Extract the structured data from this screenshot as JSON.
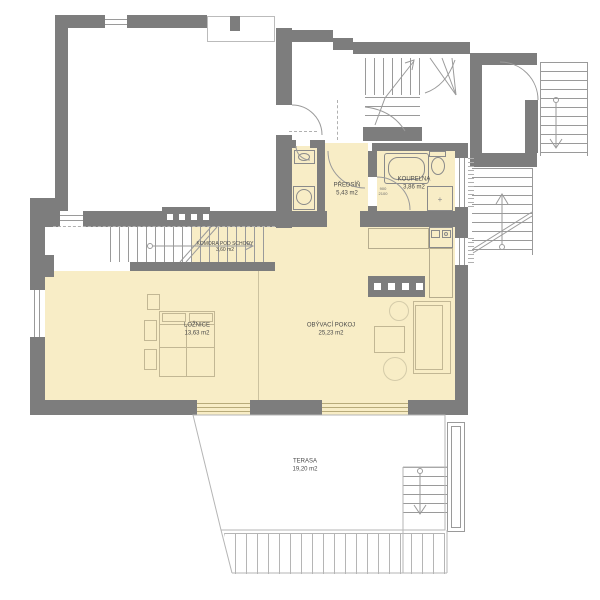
{
  "colors": {
    "wall": "#7d7d7d",
    "room_fill": "#f8edc6",
    "line": "#9a9a9a",
    "furniture_line": "#c2b794",
    "text": "#4a4a4a"
  },
  "rooms": [
    {
      "name": "KOMORA POD SCHODY",
      "area": "3,60 m2"
    },
    {
      "name": "PŘEDSÍŇ",
      "area": "5,43 m2"
    },
    {
      "name": "KOUPELNA",
      "area": "3,86 m2"
    },
    {
      "name": "LOŽNICE",
      "area": "13,63 m2"
    },
    {
      "name": "OBÝVACÍ POKOJ",
      "area": "25,23 m2"
    },
    {
      "name": "TERASA",
      "area": "19,20 m2"
    }
  ],
  "annotations": {
    "door": {
      "width": "900",
      "height": "2100"
    }
  }
}
